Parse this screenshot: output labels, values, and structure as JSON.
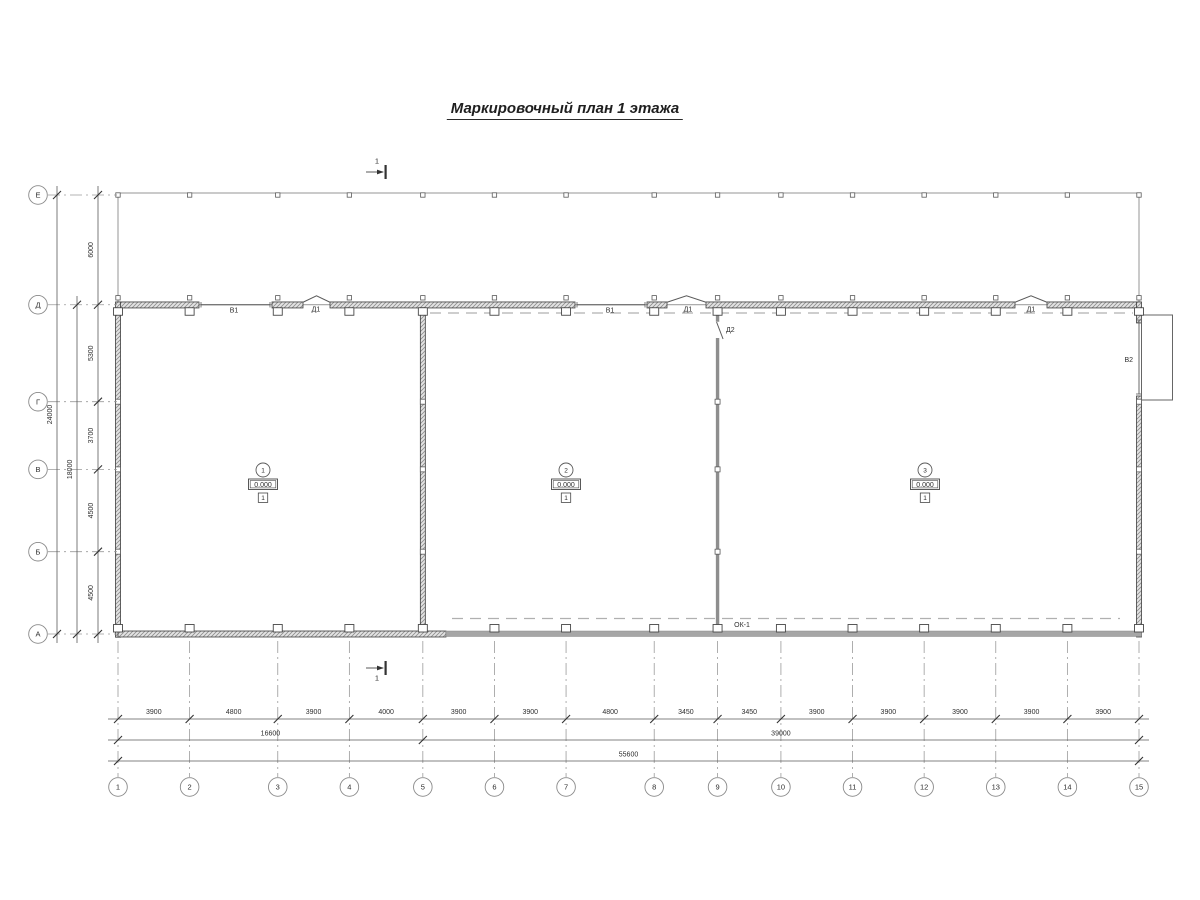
{
  "title": "Маркировочный план 1 этажа",
  "section": {
    "label": "1"
  },
  "grid": {
    "col_labels": [
      "1",
      "2",
      "3",
      "4",
      "5",
      "6",
      "7",
      "8",
      "9",
      "10",
      "11",
      "12",
      "13",
      "14",
      "15"
    ],
    "col_spans_mm": [
      3900,
      4800,
      3900,
      4000,
      3900,
      3900,
      4800,
      3450,
      3450,
      3900,
      3900,
      3900,
      3900,
      3900
    ],
    "row_labels": [
      "Е",
      "Д",
      "Г",
      "В",
      "Б",
      "А"
    ],
    "row_spans_mm": [
      6000,
      5300,
      3700,
      4500,
      4500
    ]
  },
  "dimensions": {
    "col_segments": [
      "3900",
      "4800",
      "3900",
      "4000",
      "3900",
      "3900",
      "4800",
      "3450",
      "3450",
      "3900",
      "3900",
      "3900",
      "3900",
      "3900"
    ],
    "col_group_left": "16600",
    "col_group_right": "39000",
    "col_total": "55600",
    "row_segments": [
      "6000",
      "5300",
      "3700",
      "4500",
      "4500"
    ],
    "row_group": "18000",
    "row_total": "24000"
  },
  "rooms": [
    {
      "number": "1",
      "elevation": "0.000",
      "floor_type": "1"
    },
    {
      "number": "2",
      "elevation": "0.000",
      "floor_type": "1"
    },
    {
      "number": "3",
      "elevation": "0.000",
      "floor_type": "1"
    }
  ],
  "openings": [
    {
      "id": "gate-v1-room1",
      "label": "В1"
    },
    {
      "id": "door-d1-room1",
      "label": "Д1"
    },
    {
      "id": "gate-v1-room2",
      "label": "В1"
    },
    {
      "id": "door-d1-room2",
      "label": "Д1"
    },
    {
      "id": "door-d2-interior",
      "label": "Д2"
    },
    {
      "id": "door-d1-room3",
      "label": "Д1"
    },
    {
      "id": "gate-v2-east",
      "label": "В2"
    },
    {
      "id": "window-strip",
      "label": "ОК-1"
    }
  ],
  "colors": {
    "line_dark": "#3d3d3d",
    "line_mid": "#5a5a5a",
    "line_light": "#8a8a8a",
    "dashed_gray": "#b0b0b0",
    "hatch_bg": "#e3e3e3",
    "glazing_gray": "#a6a6a6",
    "interior_wall_gray": "#8e8e8e"
  }
}
